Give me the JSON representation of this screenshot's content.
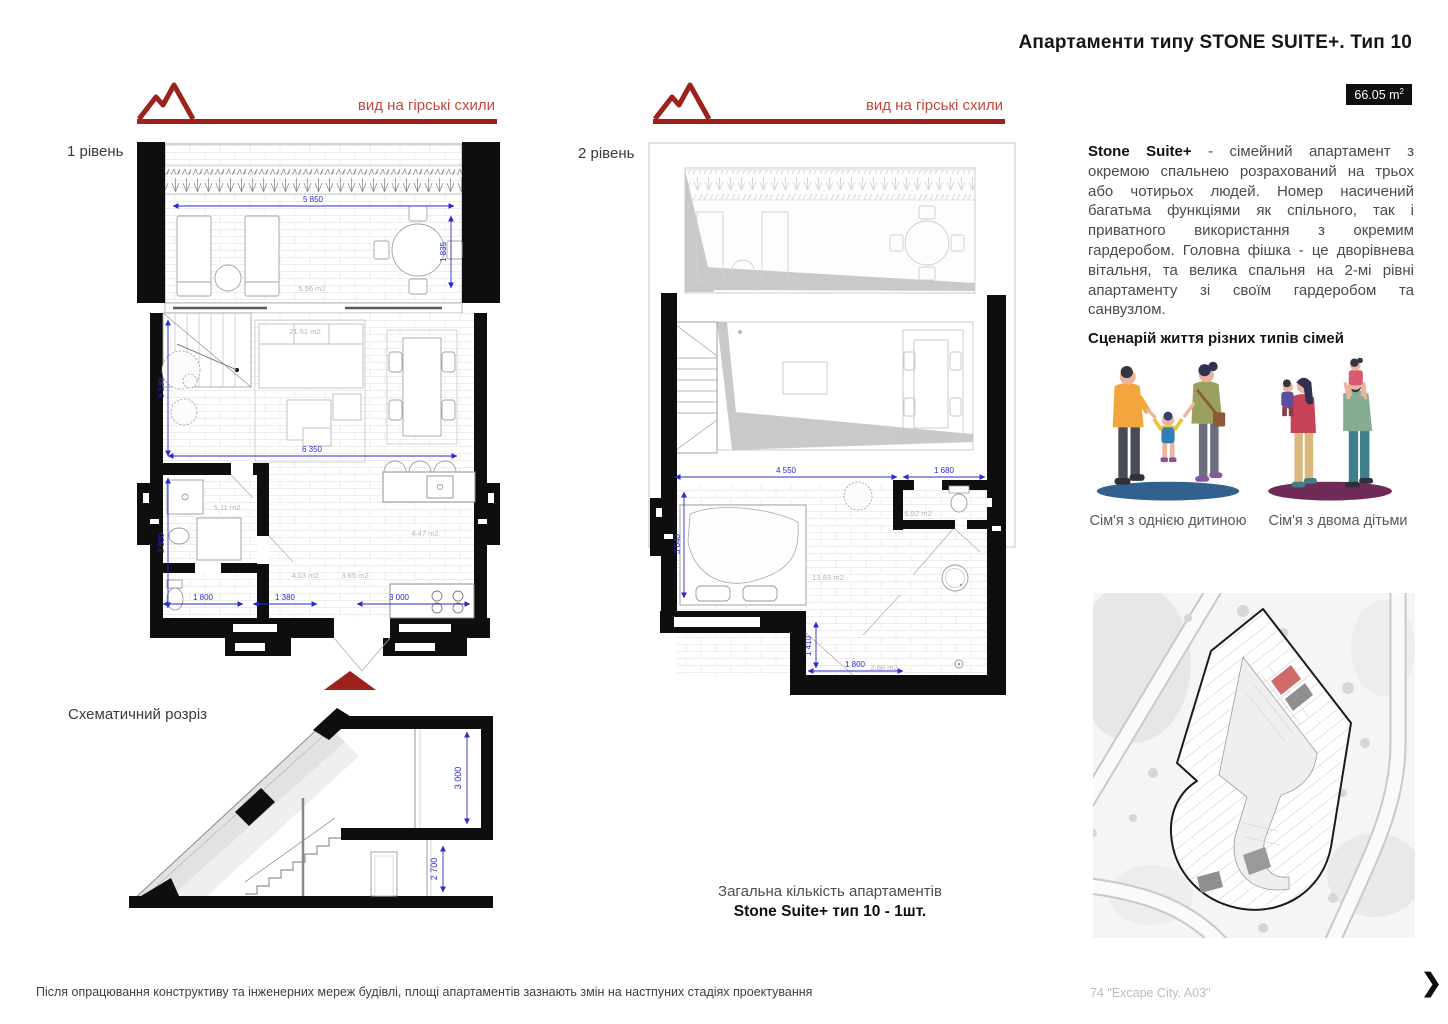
{
  "header": {
    "title": "Апартаменти типу STONE SUITE+. Тип 10",
    "area_badge": {
      "value": "66.05 m",
      "sup": "2"
    }
  },
  "view_banner": {
    "label": "вид на гірські схили"
  },
  "level1": {
    "label": "1 рівень",
    "dims": {
      "terrace_width": "5 850",
      "terrace_depth": "1 835",
      "living_height": "3 130",
      "living_width": "6 350",
      "bath_height": "2 920",
      "wc_width": "1 800",
      "hall_width": "1 380",
      "kitchen_width": "3 000"
    },
    "areas": {
      "terrace": "5.56 m2",
      "living": "21.61 m2",
      "bathroom": "5.11 m2",
      "kitchen": "4.47 m2",
      "hall": "4.03 m2",
      "corridor": "3.65 m2"
    }
  },
  "level2": {
    "label": "2 рівень",
    "dims": {
      "bedroom_width": "4 550",
      "wardrobe_width": "1 680",
      "bedroom_depth": "3 040",
      "bath_depth": "1 410",
      "bath_width": "1 800"
    },
    "areas": {
      "bedroom": "13.83 m2",
      "wardrobe": "6.92 m2",
      "bathroom": "2.68 m2"
    }
  },
  "section": {
    "label": "Схематичний розріз",
    "dims": {
      "upper_floor_height": "3 000",
      "lower_floor_height": "2 700"
    }
  },
  "description": {
    "lead": "Stone Suite+",
    "body": " - сімейний апартамент з окремою спальнею розрахований на трьох або чотирьох людей. Номер насичений багатьма функціями як спільного, так і приватного використання з окремим гардеробом. Головна фішка - це дворівнева вітальня, та велика спальня на 2-мі рівні апартаменту зі своїм гардеробом та санвузлом."
  },
  "scenario": {
    "heading": "Сценарій життя різних типів сімей",
    "families": [
      {
        "caption": "Сім'я з однією дитиною"
      },
      {
        "caption": "Сім'я з двома дітьми"
      }
    ]
  },
  "totals": {
    "line1": "Загальна кількість апартаментів",
    "line2": "Stone Suite+ тип 10 - 1шт."
  },
  "footer": {
    "disclaimer": "Після опрацювання конструктиву та інженерних мереж будівлі, площі апартаментів зазнають змін на настпуних стадіях проектування",
    "page_ref": "74 \"Excape City. A03\"",
    "next": "❯"
  },
  "colors": {
    "accent_red_dark": "#9e211b",
    "accent_red_text": "#c2473f",
    "dimension_blue": "#2a2ad0",
    "wall_black": "#0e0e0e",
    "area_label_gray": "#b8b8b8",
    "site_unit_highlight": "#d06a6a"
  }
}
